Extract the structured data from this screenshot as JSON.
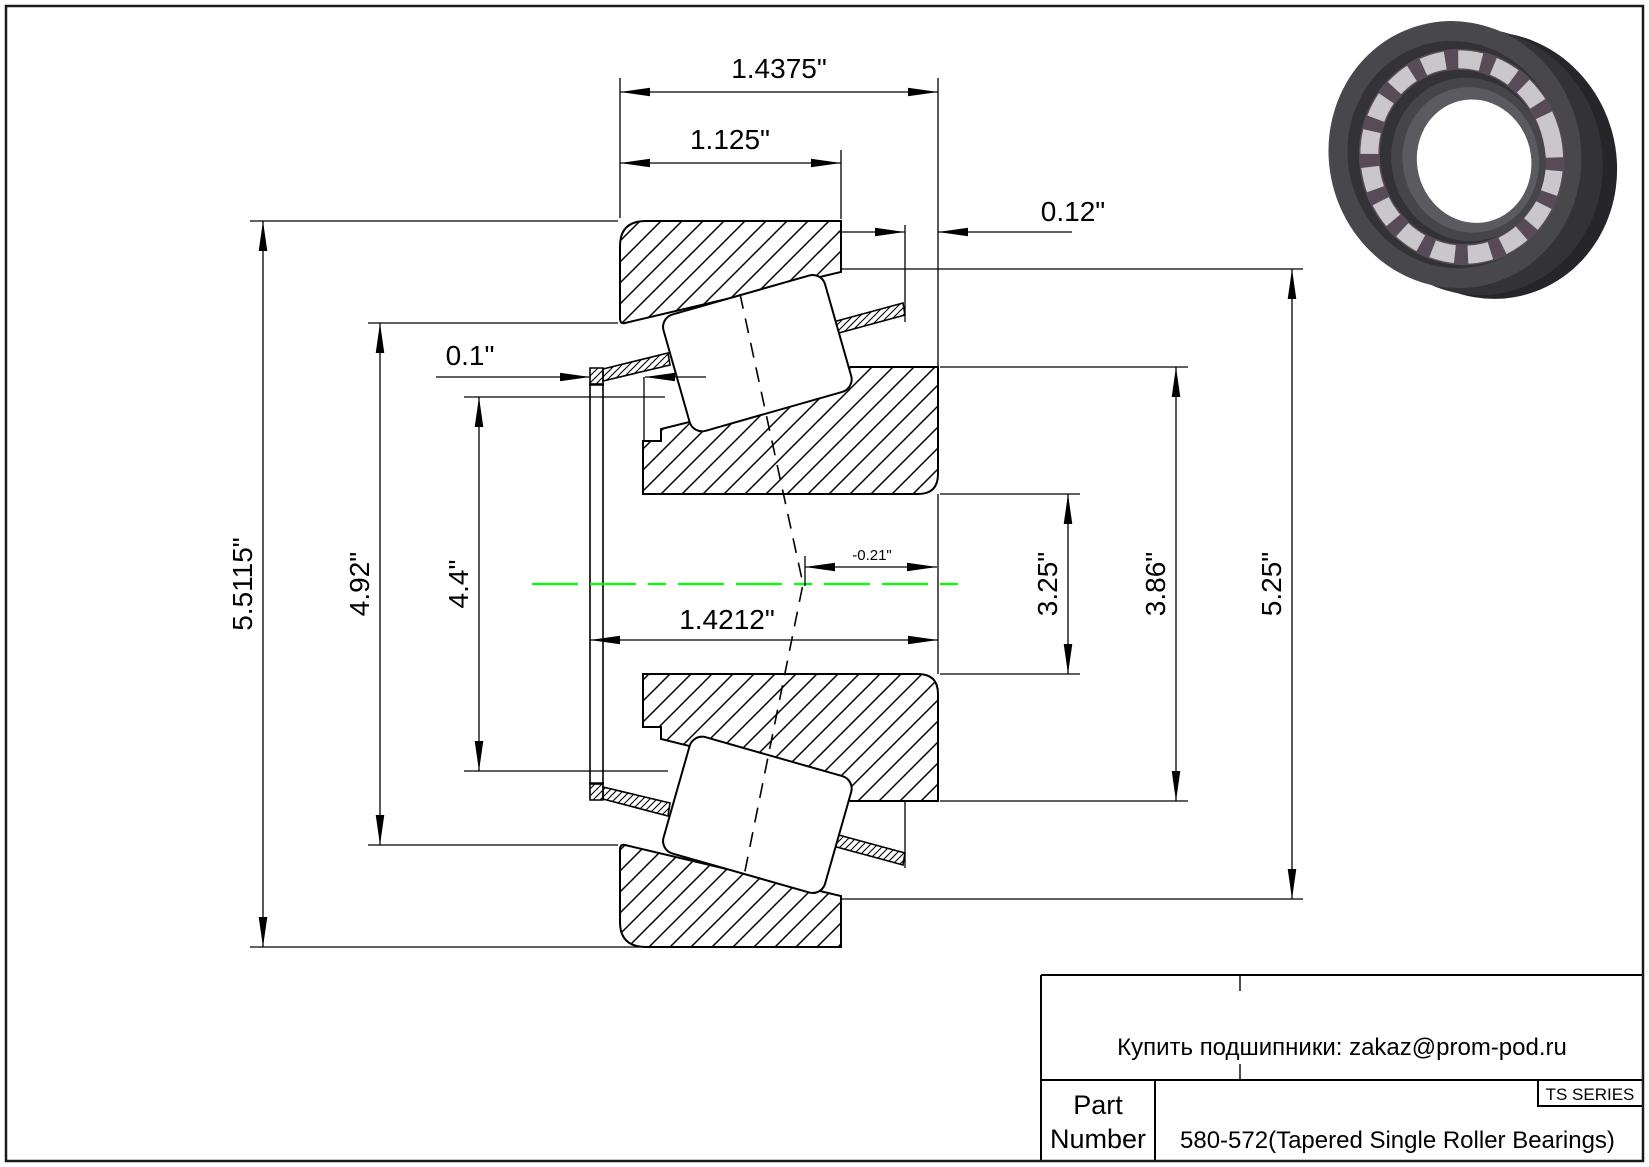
{
  "page": {
    "background": "#ffffff",
    "border_color": "#1a1a1a"
  },
  "drawing": {
    "type": "tapered-roller-bearing-cross-section",
    "centerline_color": "#00ff00",
    "line_color": "#000000",
    "dimensions": {
      "overall_width": "1.4375\"",
      "cup_width": "1.125\"",
      "back_face_offset": "0.12\"",
      "cage_protrusion": "0.1\"",
      "cone_assembly_width": "1.4212\"",
      "effective_center": "-0.21\"",
      "outer_diameter": "5.5115\"",
      "race_large_diameter": "4.92\"",
      "race_small_diameter": "4.4\"",
      "bore_diameter": "3.25\"",
      "rib_diameter": "3.86\"",
      "cup_race_diameter": "5.25\""
    }
  },
  "title_block": {
    "supplier_note": "Купить подшипники: zakaz@prom-pod.ru",
    "part_label_line1": "Part",
    "part_label_line2": "Number",
    "part_number": "580-572(Tapered Single Roller Bearings)",
    "series": "TS SERIES"
  }
}
